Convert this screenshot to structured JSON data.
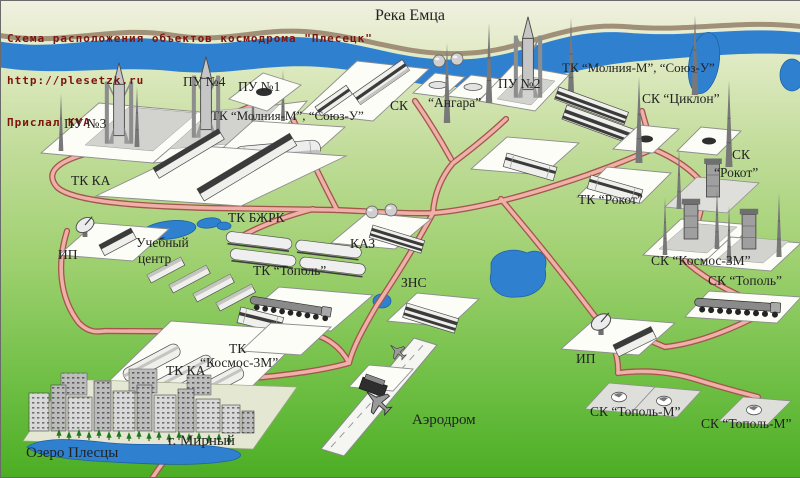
{
  "header": {
    "title": "Схема расположения объектов космодрома \"Плесецк\"",
    "url": "http://plesetzk.ru",
    "credit": "Прислал KYA"
  },
  "labels": {
    "river": "Река Емца",
    "pu4": "ПУ №4",
    "pu1": "ПУ №1",
    "pu3": "ПУ №3",
    "pu2": "ПУ №2",
    "tk_molniya_left": "ТК “Молния-М”, “Союз-У”",
    "tk_molniya_right": "ТК “Молния-М”, “Союз-У”",
    "sk_angara_prefix": "СК",
    "sk_angara_name": "“Ангара”",
    "sk_tsiklon": "СК “Циклон”",
    "sk_rokot_line1": "СК",
    "sk_rokot_line2": "“Рокот”",
    "tk_rokot": "ТК “Рокот”",
    "tk_ka_top": "ТК КА",
    "tk_ka_bottom": "ТК КА",
    "tk_bzhrk": "ТК БЖРК",
    "kaz": "КАЗ",
    "ip_left": "ИП",
    "ip_right": "ИП",
    "training_line1": "Учебный",
    "training_line2": "центр",
    "tk_topol": "ТК “Тополь”",
    "zns": "ЗНС",
    "tk_kosmos_line1": "ТК",
    "tk_kosmos_line2": "“Космос-3М”",
    "sk_kosmos": "СК “Космос-3М”",
    "sk_topol": "СК “Тополь”",
    "sk_topol_m_left": "СК “Тополь-М”",
    "sk_topol_m_right": "СК “Тополь-М”",
    "aerodrome": "Аэродром",
    "mirny": "г. Мирный",
    "lake_plesetsy": "Озеро Плесцы"
  },
  "colors": {
    "header_text": "#7d140e",
    "river": "#2f80cf",
    "road_fill": "#eeb0a8",
    "road_border": "#a2564c",
    "label_text": "#222222",
    "ground_top": "#f0f0e0",
    "ground_bottom": "#4cae24"
  }
}
